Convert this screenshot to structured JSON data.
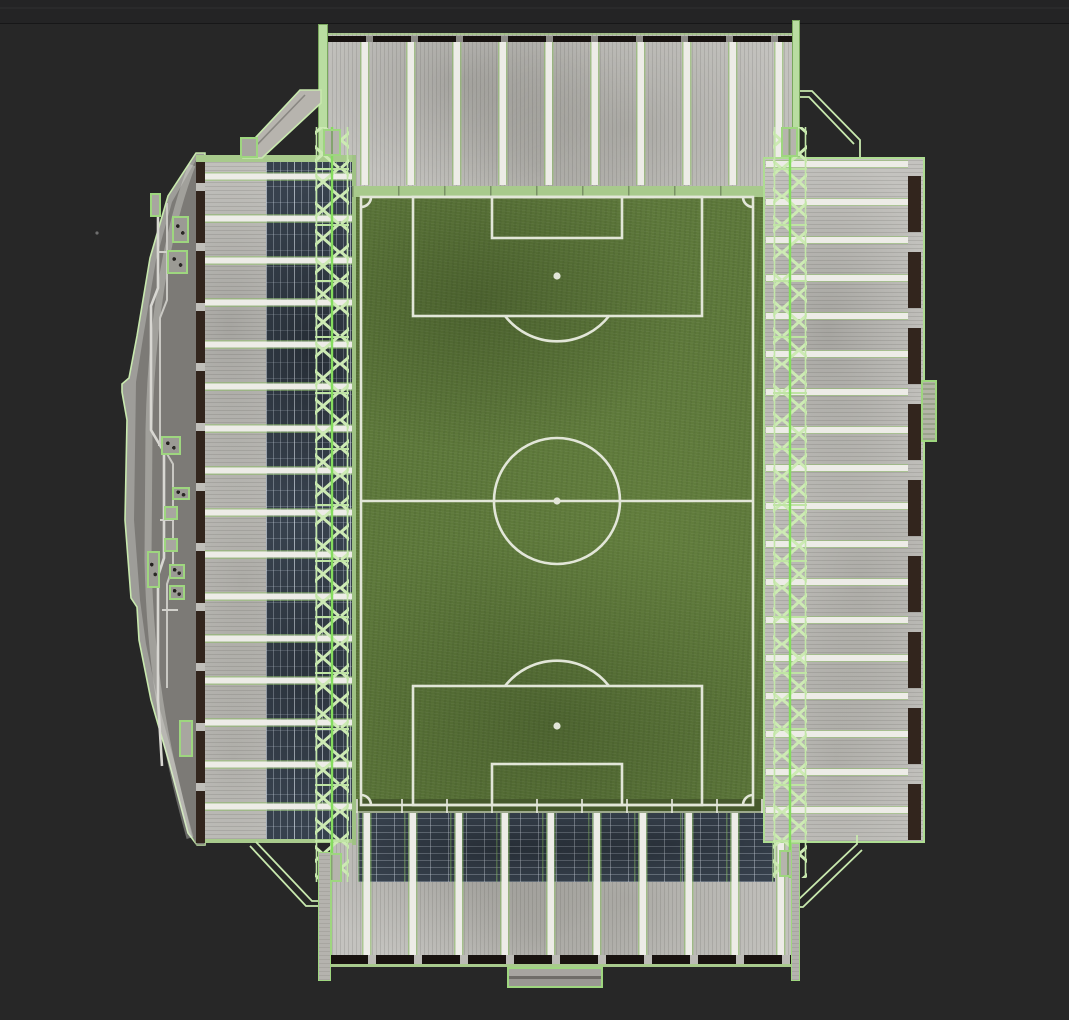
{
  "scene": {
    "subject": "football-stadium-top-down-render",
    "stands": [
      {
        "id": "north",
        "features": [
          "ribbed-concrete-roof",
          "walkway-stripes",
          "edge-truss-bars"
        ]
      },
      {
        "id": "east",
        "features": [
          "ribbed-concrete-roof",
          "walkway-stripes",
          "wireframe-truss",
          "side-gate"
        ]
      },
      {
        "id": "south",
        "features": [
          "ribbed-concrete-roof",
          "open-roof-seating",
          "players-tunnel"
        ]
      },
      {
        "id": "west",
        "features": [
          "curved-outer-concourse",
          "pipes",
          "equipment-boxes",
          "open-roof-seating",
          "wireframe-truss"
        ]
      }
    ],
    "pitch": {
      "markings": [
        "boundary",
        "halfway-line",
        "center-circle",
        "center-spot",
        "penalty-area-north",
        "goal-area-north",
        "penalty-spot-north",
        "penalty-arc-north",
        "penalty-area-south",
        "goal-area-south",
        "penalty-spot-south",
        "penalty-arc-south",
        "corner-arc-nw",
        "corner-arc-ne",
        "corner-arc-sw",
        "corner-arc-se"
      ],
      "surround": "perimeter-wall-band"
    },
    "wireframe_details": [
      "north-west-access-ramp",
      "north-east-access-wireframe",
      "south-west-stair-wireframe",
      "south-east-stair-wireframe"
    ]
  },
  "colors": {
    "bg": "#272727",
    "concrete": "#c4c3bf",
    "concrete_white": "#edece7",
    "wall_gray": "#9e9d99",
    "brown": "#32251d",
    "dark_edge": "#191310",
    "green_bright": "#84dc5e",
    "green_pale": "#c8e9ae",
    "green_mid": "#9ed67f",
    "green_band": "#a8ca8c",
    "green_edge": "#aedd92",
    "seat_base": "#37414d",
    "grass": "#5d783a",
    "grass_dark": "#46592c",
    "pitch_line": "#e2e6d8"
  }
}
